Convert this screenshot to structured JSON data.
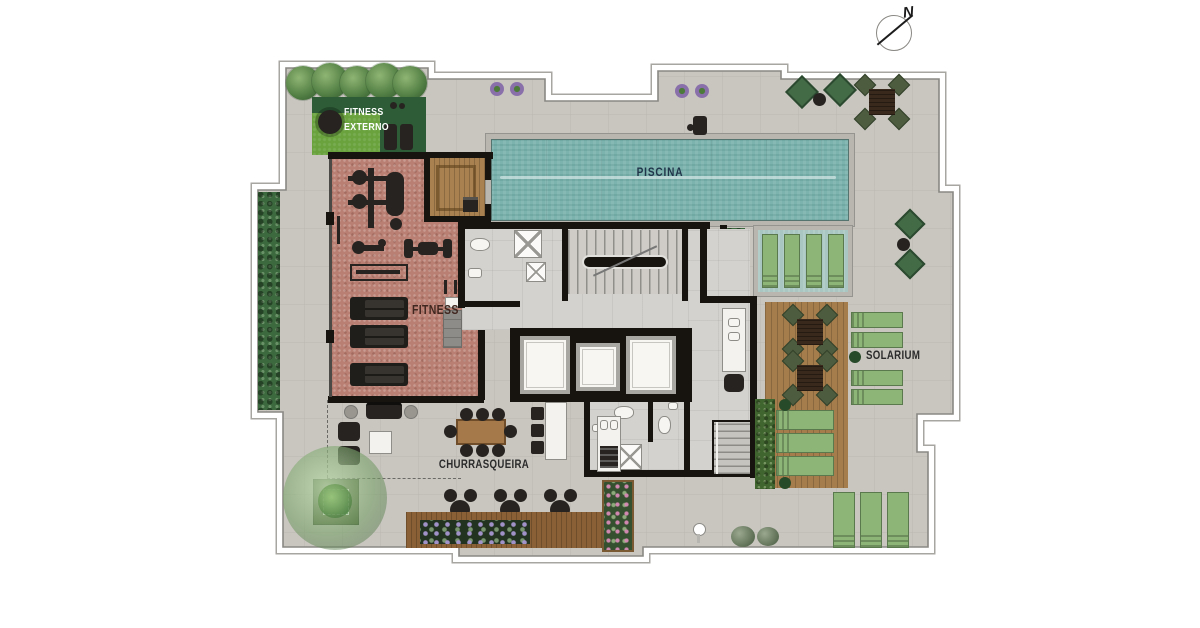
{
  "compass": {
    "north_label": "N"
  },
  "plan": {
    "areas": {
      "fitness_externo": {
        "line1": "FITNESS",
        "line2": "EXTERNO",
        "floor_color": "#6aa33e"
      },
      "piscina": {
        "label": "PISCINA",
        "water_color": "#7db3ae"
      },
      "fitness": {
        "label": "FITNESS",
        "floor_color": "#b97f72"
      },
      "solarium": {
        "label": "SOLARIUM",
        "deck_color": "#a57c4b"
      },
      "churrasqueira": {
        "label": "CHURRASQUEIRA"
      }
    },
    "palette": {
      "deck_concrete": "#c9c6c0",
      "walls": "#17140f",
      "hedge_green": "#3c6a3e",
      "lounger_green": "#8cb577",
      "wood_deck": "#a57c4b",
      "label_dark": "#2b2b2b",
      "piscina_label_color": "#20354a",
      "fitness_externo_label_color": "#ffffff"
    }
  }
}
